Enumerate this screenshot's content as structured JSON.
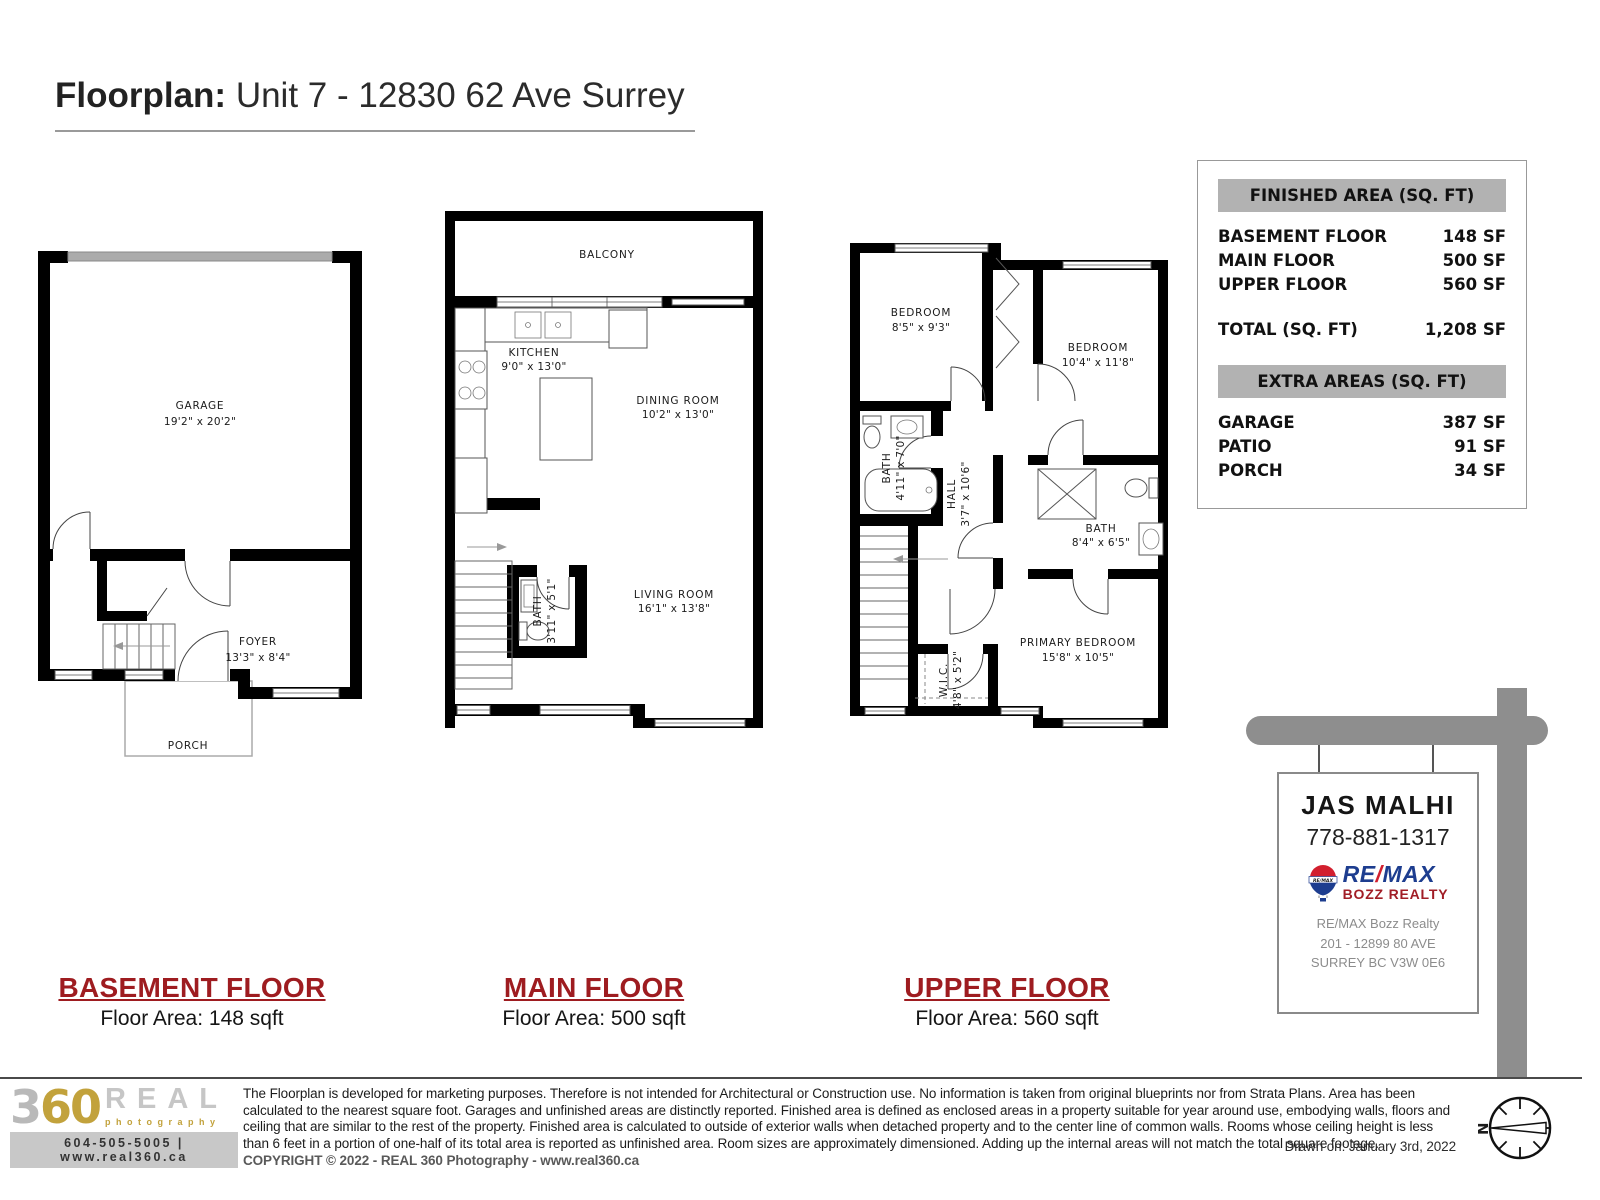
{
  "title": {
    "prefix": "Floorplan:",
    "address": " Unit 7 - 12830 62 Ave Surrey"
  },
  "area_table": {
    "finished_header": "FINISHED AREA (SQ. FT)",
    "rows": [
      {
        "label": "BASEMENT FLOOR",
        "value": "148 SF"
      },
      {
        "label": "MAIN FLOOR",
        "value": "500 SF"
      },
      {
        "label": "UPPER FLOOR",
        "value": "560 SF"
      }
    ],
    "total_label": "TOTAL (SQ. FT)",
    "total_value": "1,208 SF",
    "extra_header": "EXTRA AREAS (SQ. FT)",
    "extra_rows": [
      {
        "label": "GARAGE",
        "value": "387 SF"
      },
      {
        "label": "PATIO",
        "value": "91 SF"
      },
      {
        "label": "PORCH",
        "value": "34 SF"
      }
    ]
  },
  "plans": {
    "basement": {
      "rooms": [
        {
          "name": "GARAGE",
          "dims": "19'2\" x 20'2\""
        },
        {
          "name": "FOYER",
          "dims": "13'3\" x 8'4\""
        },
        {
          "name": "PORCH",
          "dims": ""
        }
      ]
    },
    "main": {
      "rooms": [
        {
          "name": "BALCONY",
          "dims": ""
        },
        {
          "name": "KITCHEN",
          "dims": "9'0\" x 13'0\""
        },
        {
          "name": "DINING ROOM",
          "dims": "10'2\" x 13'0\""
        },
        {
          "name": "BATH",
          "dims": "3'11\" x 5'1\""
        },
        {
          "name": "LIVING ROOM",
          "dims": "16'1\" x 13'8\""
        }
      ]
    },
    "upper": {
      "rooms": [
        {
          "name": "BEDROOM",
          "dims": "8'5\" x 9'3\""
        },
        {
          "name": "BEDROOM",
          "dims": "10'4\" x 11'8\""
        },
        {
          "name": "BATH",
          "dims": "4'11\" x 7'0\""
        },
        {
          "name": "HALL",
          "dims": "3'7\" x 10'6\""
        },
        {
          "name": "BATH",
          "dims": "8'4\" x 6'5\""
        },
        {
          "name": "W.I.C.",
          "dims": "4'8\" x 5'2\""
        },
        {
          "name": "PRIMARY BEDROOM",
          "dims": "15'8\" x 10'5\""
        }
      ]
    }
  },
  "floor_labels": [
    {
      "title": "BASEMENT FLOOR",
      "subtitle": "Floor Area: 148 sqft"
    },
    {
      "title": "MAIN FLOOR",
      "subtitle": "Floor Area: 500 sqft"
    },
    {
      "title": "UPPER FLOOR",
      "subtitle": "Floor Area: 560 sqft"
    }
  ],
  "sign": {
    "agent": "JAS MALHI",
    "phone": "778-881-1317",
    "brand_re": "RE",
    "brand_slash": "/",
    "brand_max": "MAX",
    "brand_sub": "BOZZ REALTY",
    "balloon_text": "RE/MAX",
    "office_line1": "RE/MAX Bozz Realty",
    "office_line2": "201 - 12899 80 AVE",
    "office_line3": "SURREY BC V3W 0E6"
  },
  "footer": {
    "logo_3": "3",
    "logo_6": "6",
    "logo_0": "0",
    "logo_real": "REAL",
    "logo_photography": "photography",
    "logo_contact": "604-505-5005 | www.real360.ca",
    "disclaimer": "The Floorplan is developed for marketing purposes. Therefore is not intended for Architectural or Construction use. No information is taken from original blueprints nor from Strata Plans. Area has been calculated to the nearest square foot. Garages and unfinished areas are distinctly reported. Finished area is defined as enclosed areas in a property suitable for year around use, embodying walls, floors and ceiling that are similar to the rest of the property. Finished area is calculated to outside of exterior walls when detached property and to the center line of common walls. Rooms whose ceiling height is less than 6 feet  in a portion of one-half of its total area is reported as unfinished area. Room sizes are approximately dimensioned. Adding up the internal areas will not match the total square footage. ",
    "copyright": "COPYRIGHT © 2022 - REAL 360 Photography - www.real360.ca",
    "drawn_on": "Drawn on: January 3rd, 2022",
    "compass_n": "N"
  },
  "colors": {
    "accent_red": "#9E1C20",
    "remax_blue": "#1D3D8F",
    "remax_red": "#D21F2E",
    "sign_gray": "#8E8E8E",
    "gold": "#C2A23C"
  }
}
